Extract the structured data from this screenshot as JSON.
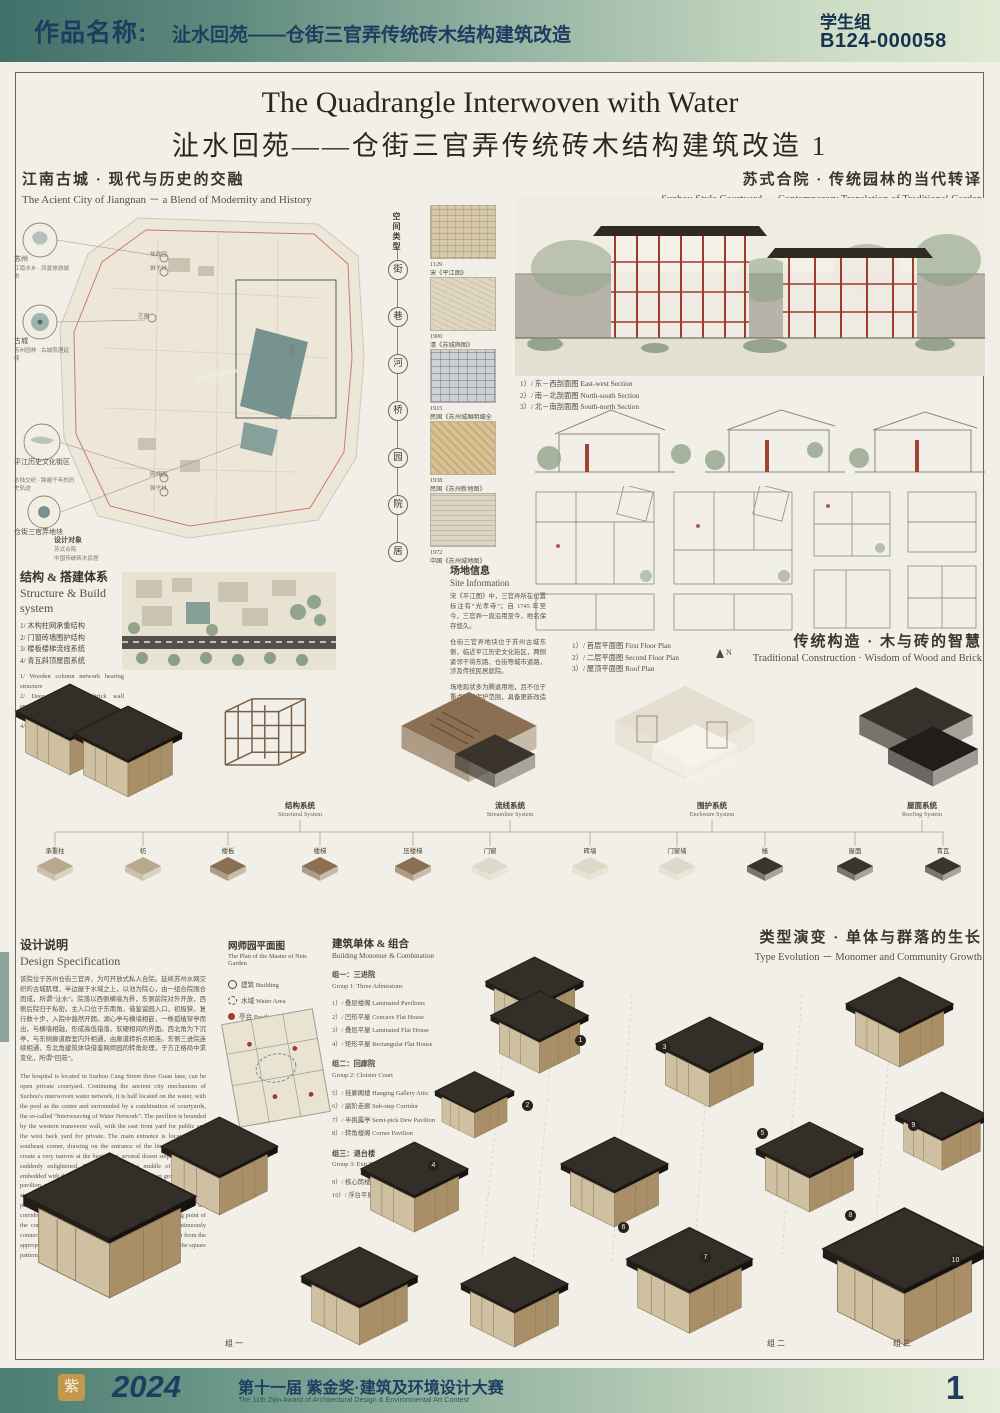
{
  "header": {
    "label": "作品名称:",
    "title": "沚水回苑——仓街三官弄传统砖木结构建筑改造",
    "group": "学生组",
    "code": "B124-000058"
  },
  "title": {
    "en": "The Quadrangle Interwoven with Water",
    "zh": "沚水回苑——仓街三官弄传统砖木结构建筑改造 1"
  },
  "intro_left": {
    "zh": "江南古城 · 现代与历史的交融",
    "en": "The Acient City of Jiangnan － a Blend of Modernity and History"
  },
  "intro_right": {
    "zh": "苏式合院 · 传统园林的当代转译",
    "en": "Suzhou Style Courtyard － Contemporary Translation of Traditional Garden"
  },
  "site_map": {
    "nodes": [
      {
        "label": "苏州",
        "note": "江南水乡 · 风景旅游城市"
      },
      {
        "label": "古城",
        "note": "苏州园林 · 古城肌理延续"
      },
      {
        "label": "平江历史文化街区",
        "note": "水陆交织 · 跨越千年的历史轨迹"
      },
      {
        "label": "仓街三官弄地块",
        "note": ""
      }
    ],
    "gardens": [
      "拙政园",
      "狮子林",
      "艺圃",
      "网师园",
      "狮子林"
    ],
    "site_label": "仓街三官弄地块",
    "street": "仓街",
    "target_lines": [
      "设计对象",
      "苏式合院",
      "中国传统砖木民居"
    ]
  },
  "timeline": {
    "title": "空间类型",
    "items": [
      "街",
      "巷",
      "河",
      "桥",
      "园",
      "院",
      "居"
    ]
  },
  "map_thumbs": [
    {
      "year": "1129",
      "caption": "宋《平江图》"
    },
    {
      "year": "1900",
      "caption": "清《苏城舆图》"
    },
    {
      "year": "1915",
      "caption": "民国《苏州城厢明细全图》"
    },
    {
      "year": "1938",
      "caption": "民国《苏州新地图》"
    },
    {
      "year": "1972",
      "caption": "中国《苏州城地图》"
    }
  ],
  "section_labels": [
    "1）/ 东－西剖面图 East-west Section",
    "2）/ 南－北剖面图 North-south Section",
    "3）/ 北－南剖面图 South-north Section"
  ],
  "plan_labels": [
    "1）/ 首层平面图 First Floor Plan",
    "2）/ 二层平面图 Second Floor Plan",
    "3）/ 屋顶平面图 Roof Plan"
  ],
  "compass": "N",
  "structure": {
    "zh": "结构 & 搭建体系",
    "en": "Structure & Build system",
    "items_zh": [
      "1/ 木构柱网承重结构",
      "2/ 门窗砖墙围护结构",
      "3/ 楼板楼梯流线系统",
      "4/ 青瓦斜顶屋面系统"
    ],
    "items_en": [
      "1/ Wooden column network bearing structure",
      "2/ Door and window brick wall enclosure structure",
      "3/ Floor staircase streamline system",
      "4/ Green tile inclined roof system"
    ]
  },
  "site_info": {
    "zh": "场地信息",
    "en": "Site Information",
    "paras": [
      "宋《平江图》中，三官弄所在位置标注有“光孝寺”；自 1745 年至今，三官弄一直沿用至今，地名保存悠久。",
      "仓街三官弄地块位于苏州古城东侧，临近平江历史文化街区，两侧紧邻干将东路、仓街等城市道路，涉及传统民居庭院。",
      "场地现状多为腾退用地，且不位于重点民居保护范围，具备更新改造条件。"
    ]
  },
  "traditional": {
    "zh": "传统构造 · 木与砖的智慧",
    "en": "Traditional Construction · Wisdom of Wood and Brick"
  },
  "systems": [
    {
      "zh": "结构系统",
      "en": "Structural System"
    },
    {
      "zh": "流线系统",
      "en": "Streamline System"
    },
    {
      "zh": "围护系统",
      "en": "Enclosure System"
    },
    {
      "zh": "屋面系统",
      "en": "Roofing System"
    }
  ],
  "components": [
    "承重柱",
    "枋",
    "楼板",
    "楼梯",
    "压楼梯",
    "门窗",
    "砖墙",
    "门窗墙",
    "椽",
    "屋面",
    "青瓦"
  ],
  "design_spec": {
    "zh": "设计说明",
    "en": "Design Specification",
    "zh_para": "该院位于苏州仓街三官弄，为可开放式私人合院。延续苏州水网交织的古城肌理，半边屋于水域之上，以池为院心，由一组合院围合而成，所谓“沚水”。院落以西侧横墙为界，东侧前院对外开放，西侧后院归于私密。主入口位于东南角，借鉴留园入口，初极狭，复行数十步，入院中豁然开朗。湖心亭与横墙相嵌，一株孤植穿亭而出，与横墙相融，形成高低错落、软硬相间的界面。西北角为下沉亭，与东侧廊道群室内外相通，由廊道转折点相连。东侧三进院连续相通，东北角建筑体块借鉴网师园的转角处理，于方正格局中求变化，所谓“回苑”。",
    "en_para": "The hospital is located in Suzhou Cang Street three Guan lane, can be open private courtyard. Continuing the ancient city mechanism of Suzhou's interwoven water network, it is half located on the water, with the pool as the center and surrounded by a combination of courtyards, the so-called “Interweaving of Water Network”. The pavilion is bounded by the western transverse wall, with the east front yard for public and the west back yard for private. The main entrance is located in the southeast corner, drawing on the entrance of the lingering garden to create a very narrow at the beginning, several dozen steps, the hospital suddenly enlightened. The pavilion in the middle of the lake is embedded with the transverse wall, and a solitary plant grows out of the pavilion and blends with the transverse wall to form an interface of staggered heights, soft and hard. The northwest corner is a sunken pavilion, which is connected with the interior and exterior of the corridor group on the east side, and is connected by the turning point of the corridor. On the east side, the three courtyards are continuously connected, and the building blocks in the northeast corner learn from the appropriate corners of the Master Garden and seek changes in the square pattern, the so-called “Quadrangle Courtyard”."
  },
  "nets_garden": {
    "zh": "网师园平面图",
    "en": "The Plan of the Master of Nets Garden",
    "legend": [
      "建筑 Building",
      "水域 Water Area",
      "亭台 Pavilion"
    ]
  },
  "monomer": {
    "zh": "建筑单体 & 组合",
    "en": "Building Monomer & Combination",
    "groups": [
      {
        "zh": "组一：三进院",
        "en": "Group 1: Three Admissions",
        "items": [
          "1）/ 叠层楼阁 Laminated Pavilions",
          "2）/ 凹形平屋 Concave Flat House",
          "3）/ 叠层平屋 Laminated Flat House",
          "4）/ 矩形平屋 Rectangular Flat House"
        ]
      },
      {
        "zh": "组二：回廊院",
        "en": "Group 2: Cloister Court",
        "items": [
          "5）/ 挂廊阁楼 Hanging Gallery Attic",
          "6）/ 副阶走廊 Sub-step Corridor",
          "7）/ 半挑露亭 Semi-pick Dew Pavilion",
          "8）/ 转角楼阁 Corner Pavilion"
        ]
      },
      {
        "zh": "组三：退台楼",
        "en": "Group 3: Exit Tower",
        "items": [
          "9）/ 核心筒楼 Core Tower",
          "10）/ 浮台平屋 Floating Terrace Flat House"
        ]
      }
    ]
  },
  "type_evolution": {
    "zh": "类型演变 · 单体与群落的生长",
    "en": "Type Evolution － Monomer and Community Growth"
  },
  "badges": [
    "1",
    "2",
    "3",
    "4",
    "5",
    "6",
    "7",
    "8",
    "9",
    "10"
  ],
  "group_captions": [
    "组一",
    "组二",
    "组三"
  ],
  "footer": {
    "seal": "紫",
    "year": "2024",
    "title_zh": "第十一届 紫金奖·建筑及环境设计大赛",
    "title_en": "The 11th Zijin Award of Architectural Design & Environmental Art Contest",
    "page": "1"
  }
}
